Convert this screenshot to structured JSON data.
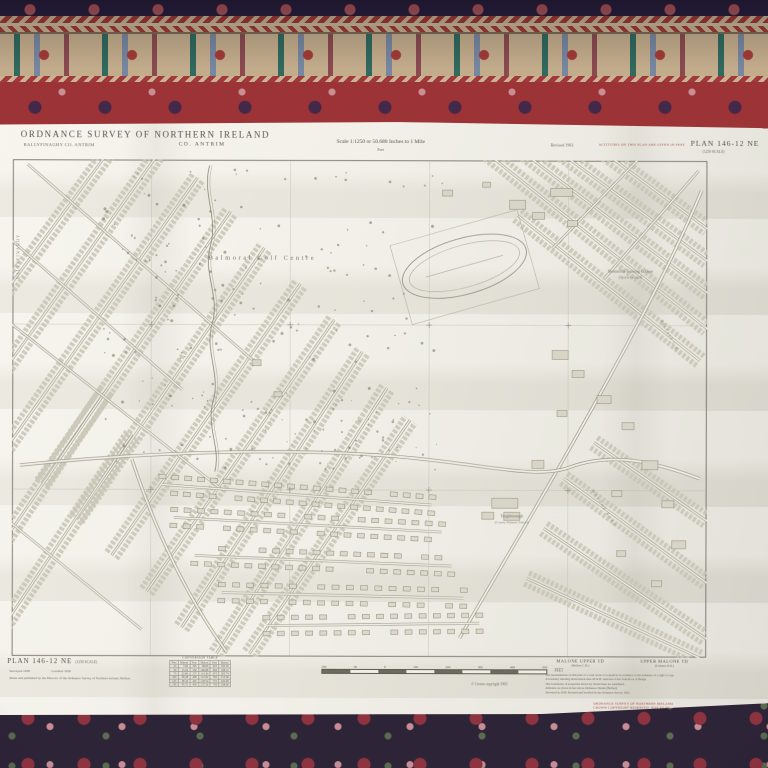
{
  "header": {
    "title": "ORDNANCE SURVEY OF NORTHERN IRELAND",
    "parish_note": "BALLYFINAGHY CO. ANTRIM",
    "county": "CO. ANTRIM",
    "scale_statement": "Scale 1:1250 or 50.688 Inches to 1 Mile",
    "scale_sub": "Feet",
    "revised": "Revised 1961",
    "altitude_note": "ALTITUDES ON THIS PLAN ARE GIVEN IN FEET",
    "plan_number": "PLAN 146-12 NE",
    "plan_scale": "(1250 SCALE)"
  },
  "map": {
    "labels": {
      "golf_course": "Balmoral Golf Centre",
      "college_line1": "Stranmillis Training College",
      "college_line2": "(Sports Ground)",
      "school_line1": "Taughmonagh",
      "school_line2": "(County Primary School)",
      "left_edge": "BALLYFINAGHY",
      "boundary_edge": "BELFAST C.B.",
      "road_name": "MALONE ROAD"
    }
  },
  "footer": {
    "plan_number": "PLAN 146-12 NE",
    "plan_scale": "(1250 SCALE)",
    "surveyed": "Surveyed 1938",
    "levelled": "Levelled 1956",
    "publication_note": "Made and published by the Director of the Ordnance Survey of Northern Ireland, Belfast.",
    "conversion_table": {
      "title": "CONVERSION TABLE",
      "columns": [
        "Feet",
        "Metres",
        "Feet",
        "Metres",
        "Feet",
        "Metres"
      ],
      "rows": [
        [
          "25",
          "7.62",
          "325",
          "99.06",
          "625",
          "190.50"
        ],
        [
          "50",
          "15.24",
          "350",
          "106.68",
          "650",
          "198.12"
        ],
        [
          "75",
          "22.86",
          "375",
          "114.30",
          "675",
          "205.74"
        ],
        [
          "100",
          "30.48",
          "400",
          "121.92",
          "700",
          "213.36"
        ],
        [
          "125",
          "38.10",
          "425",
          "129.54",
          "725",
          "220.98"
        ],
        [
          "150",
          "45.72",
          "450",
          "137.16",
          "750",
          "228.60"
        ]
      ]
    },
    "scale_bar": {
      "ticks": [
        "100",
        "50",
        "0",
        "100",
        "200",
        "300",
        "400",
        "500"
      ],
      "unit": "FEET"
    },
    "copyright": "© Crown copyright 1963",
    "townlands": [
      {
        "name": "MALONE UPPER TD",
        "sub": "(Belfast C.B.)"
      },
      {
        "name": "UPPER MALONE TD",
        "sub": "(Lisburn R.D.)"
      }
    ],
    "notes": [
      "The representation on this plan of a road, track or footpath is no evidence of the existence of a right of way.",
      "A boundary mereing abbreviation thus 4ft R.H. indicates 4 feet from Root of Hedge.",
      "The boundaries of properties shown by dotted lines are undefined.",
      "Altitudes are given in feet above Ordnance Datum (Belfast).",
      "Surveyed in 1938. Revised and levelled by the Ordnance Survey 1961."
    ],
    "red_stamp": [
      "ORDNANCE SURVEY OF NORTHERN IRELAND",
      "CROWN COPYRIGHT RESERVED. NOT TO BE",
      "REPRODUCED WITHOUT PERMISSION"
    ]
  },
  "colors": {
    "paper": "#efede3",
    "map_ink": "#6e6b5e",
    "red_note": "#b0433c",
    "carpet_red": "#9c3336",
    "carpet_navy": "#2b2040",
    "carpet_beige": "#c3ac8c"
  }
}
